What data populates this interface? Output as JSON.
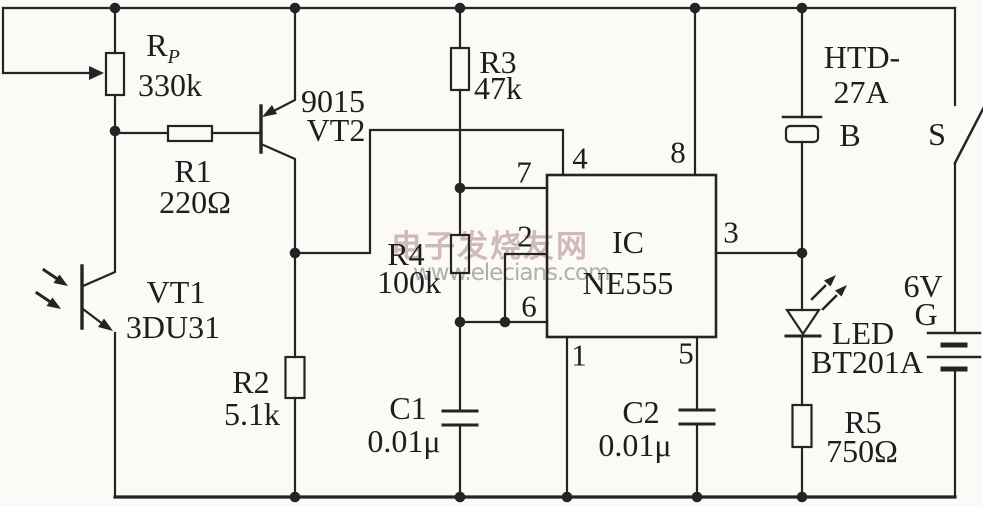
{
  "watermark": {
    "cn": "电子发烧友网",
    "url": "www.elecians.com"
  },
  "labels": {
    "rp_name": "R",
    "rp_sub": "P",
    "rp_value": "330k",
    "r1_name": "R1",
    "r1_value": "220Ω",
    "r2_name": "R2",
    "r2_value": "5.1k",
    "r3_name": "R3",
    "r3_value": "47k",
    "r4_name": "R4",
    "r4_value": "100k",
    "r5_name": "R5",
    "r5_value": "750Ω",
    "c1_name": "C1",
    "c1_value": "0.01μ",
    "c2_name": "C2",
    "c2_value": "0.01μ",
    "vt1_name": "VT1",
    "vt1_value": "3DU31",
    "vt2_part": "9015",
    "vt2_name": "VT2",
    "ic_name": "IC",
    "ic_value": "NE555",
    "buzzer_line1": "HTD-",
    "buzzer_line2": "27A",
    "buzzer_ref": "B",
    "switch_ref": "S",
    "battery_voltage": "6V",
    "battery_ref": "G",
    "led_name": "LED",
    "led_value": "BT201A"
  },
  "pins": {
    "p1": "1",
    "p2": "2",
    "p3": "3",
    "p4": "4",
    "p5": "5",
    "p6": "6",
    "p7": "7",
    "p8": "8"
  },
  "colors": {
    "line": "#242424",
    "watermark_cn": "#bfa2a2",
    "watermark_url": "#9d9d9d"
  }
}
